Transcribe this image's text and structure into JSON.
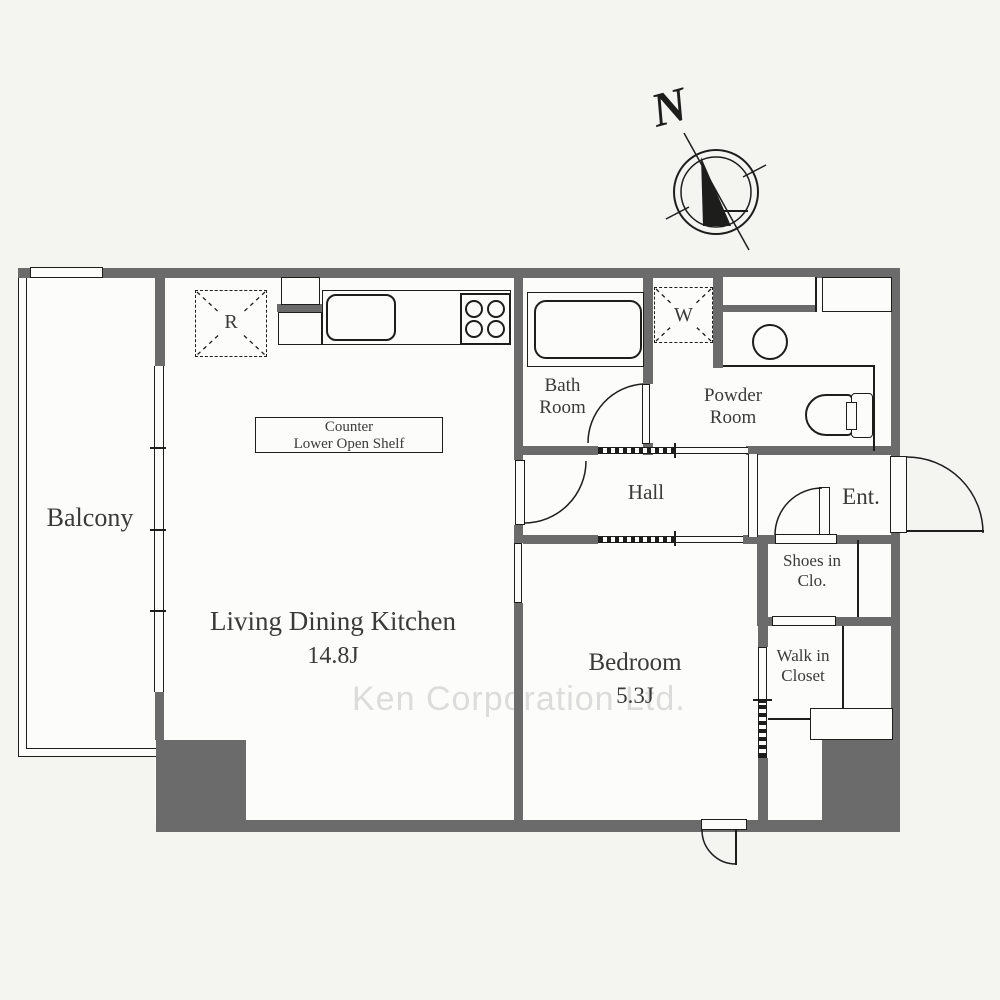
{
  "compass": {
    "north_label": "N"
  },
  "rooms": {
    "balcony": {
      "label": "Balcony"
    },
    "ldk": {
      "label": "Living Dining Kitchen",
      "size": "14.8J"
    },
    "bedroom": {
      "label": "Bedroom",
      "size": "5.3J"
    },
    "bath": {
      "line1": "Bath",
      "line2": "Room"
    },
    "powder": {
      "line1": "Powder",
      "line2": "Room"
    },
    "hall": {
      "label": "Hall"
    },
    "entrance": {
      "label": "Ent."
    },
    "shoes_closet": {
      "line1": "Shoes in",
      "line2": "Clo."
    },
    "walk_in_closet": {
      "line1": "Walk in",
      "line2": "Closet"
    }
  },
  "fixtures": {
    "refrigerator_label": "R",
    "washer_label": "W",
    "counter_note": {
      "line1": "Counter",
      "line2": "Lower Open Shelf"
    }
  },
  "watermark": {
    "text": "Ken Corporation Ltd."
  },
  "colors": {
    "wall": "#6b6b6b",
    "line": "#1d1d1b",
    "background": "#f4f4f1",
    "paper": "#fcfcfa",
    "watermark": "#dcdcdc",
    "text": "#3a3a38"
  }
}
